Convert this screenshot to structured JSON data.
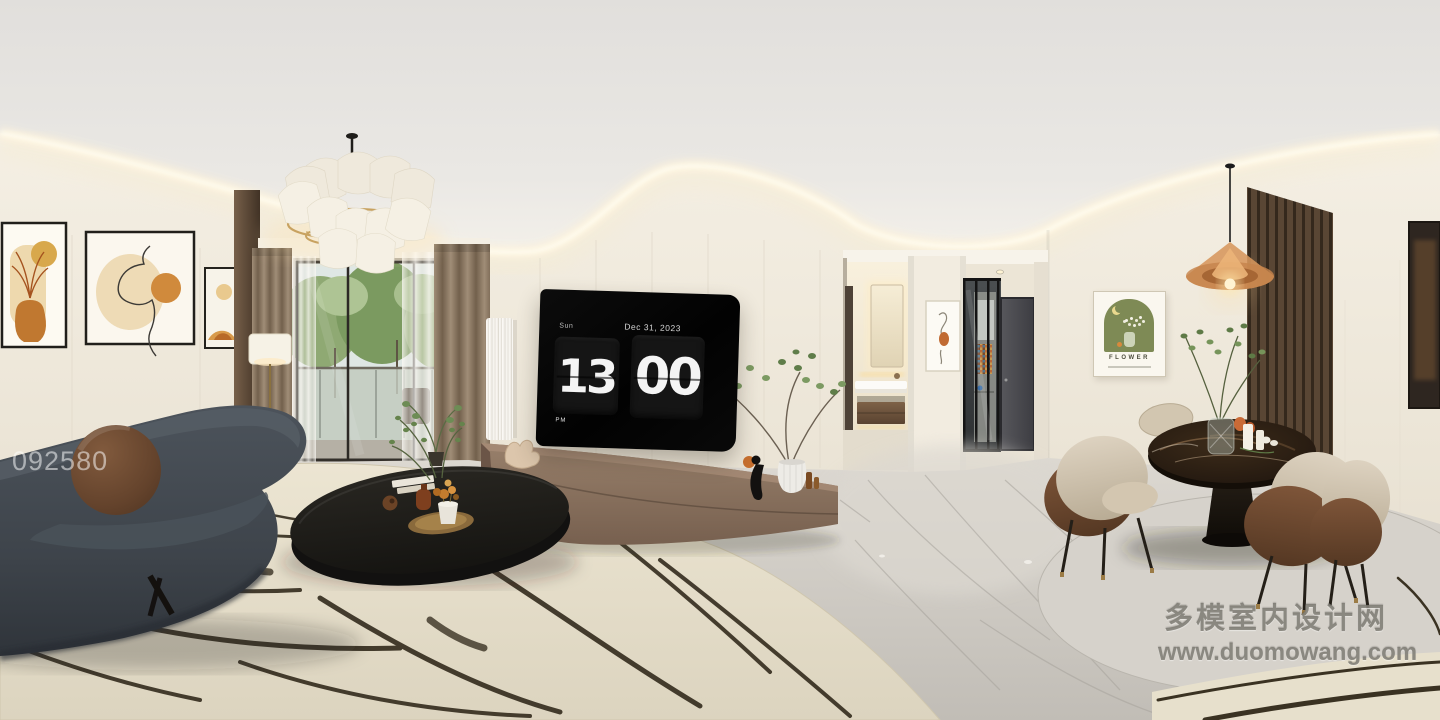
{
  "scene": {
    "description": "360-degree panorama render of a modern cream-toned apartment: living room with charcoal curved sofa and round brown pillow, black oval coffee table on a cream brushstroke rug, TV wall showing a flip clock, balcony with sheer curtains, hallway to a backlit bathroom vanity and glass-door kitchen, and a dining corner with dark marble round table, leather-back chairs, amber pendant and wood-slat accent wall",
    "rooms": [
      "living room",
      "balcony",
      "hallway",
      "bathroom",
      "kitchen",
      "dining corner"
    ]
  },
  "tv_clock": {
    "day": "Sun",
    "date": "Dec 31, 2023",
    "hours": "13",
    "minutes": "00",
    "meridiem": "PM"
  },
  "posters": {
    "flower_title": "FLOWER"
  },
  "watermarks": {
    "photo_id": "092580",
    "site_name": "多模室内设计网",
    "site_url": "www.duomowang.com"
  },
  "palette": {
    "wall_cream": "#f0ebe1",
    "ceiling": "#e9e7e3",
    "cove_light": "#fff3d9",
    "floor_marble": "#cdc9c2",
    "rug_cream": "#e9e2cf",
    "rug_stroke": "#32291b",
    "sofa_charcoal": "#454c53",
    "pillow_brown": "#6f4b33",
    "tv_black": "#070707",
    "clock_digit": "#f4f4f4",
    "bench_taupe": "#8b7263",
    "curtain_taupe": "#94826d",
    "wood_slat": "#52402f",
    "dining_marble": "#271c11",
    "chair_beige": "#d3c7b3",
    "chair_leather": "#6f4a32",
    "pendant_amber": "#d79a5e",
    "poster_green": "#7e8a55",
    "greenery": "#6d8c55",
    "art_orange": "#c98a3c"
  }
}
